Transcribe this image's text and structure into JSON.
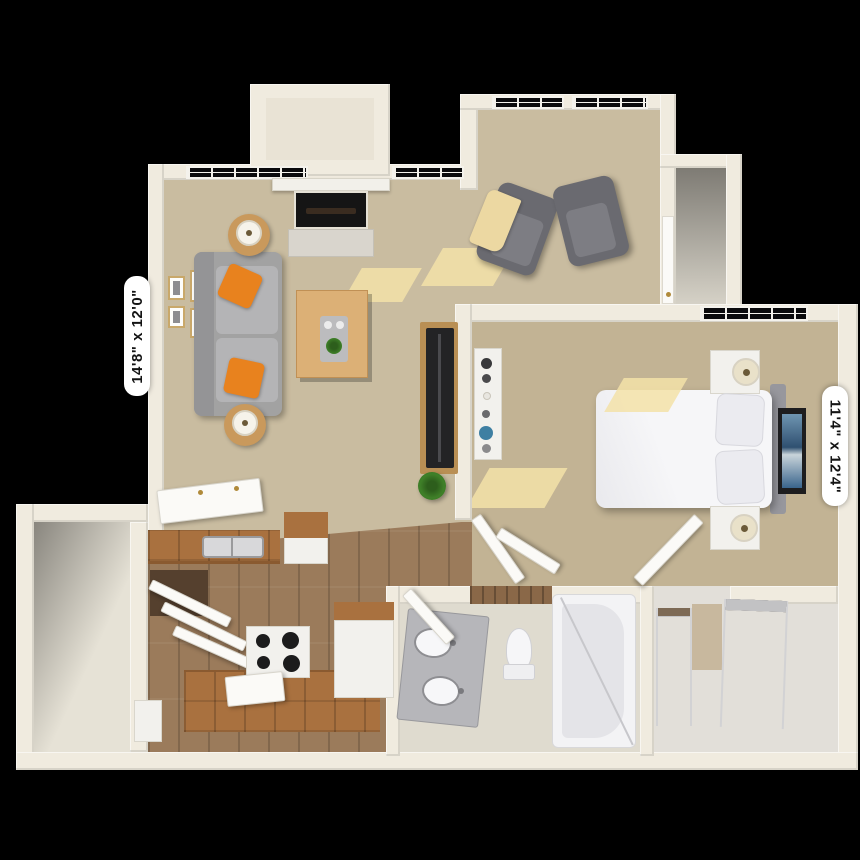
{
  "floor_plan": {
    "living_room": {
      "dimensions_label": "14'8\" x 12'0\""
    },
    "bedroom": {
      "dimensions_label": "11'4\" x 12'4\""
    }
  },
  "colors": {
    "background": "#000000",
    "wall": "#f0ebdf",
    "living_carpet": "#c9bca0",
    "bedroom_carpet": "#c2b394",
    "wood_floor": "#9b7b5b",
    "countertop": "#a9713f",
    "sofa": "#ababab",
    "accent_pillow": "#e8821e",
    "armchair": "#6a6a70",
    "throw_blanket": "#ecd8a2",
    "artwork_blue": "#2f5070",
    "plant_green": "#3f8028"
  }
}
